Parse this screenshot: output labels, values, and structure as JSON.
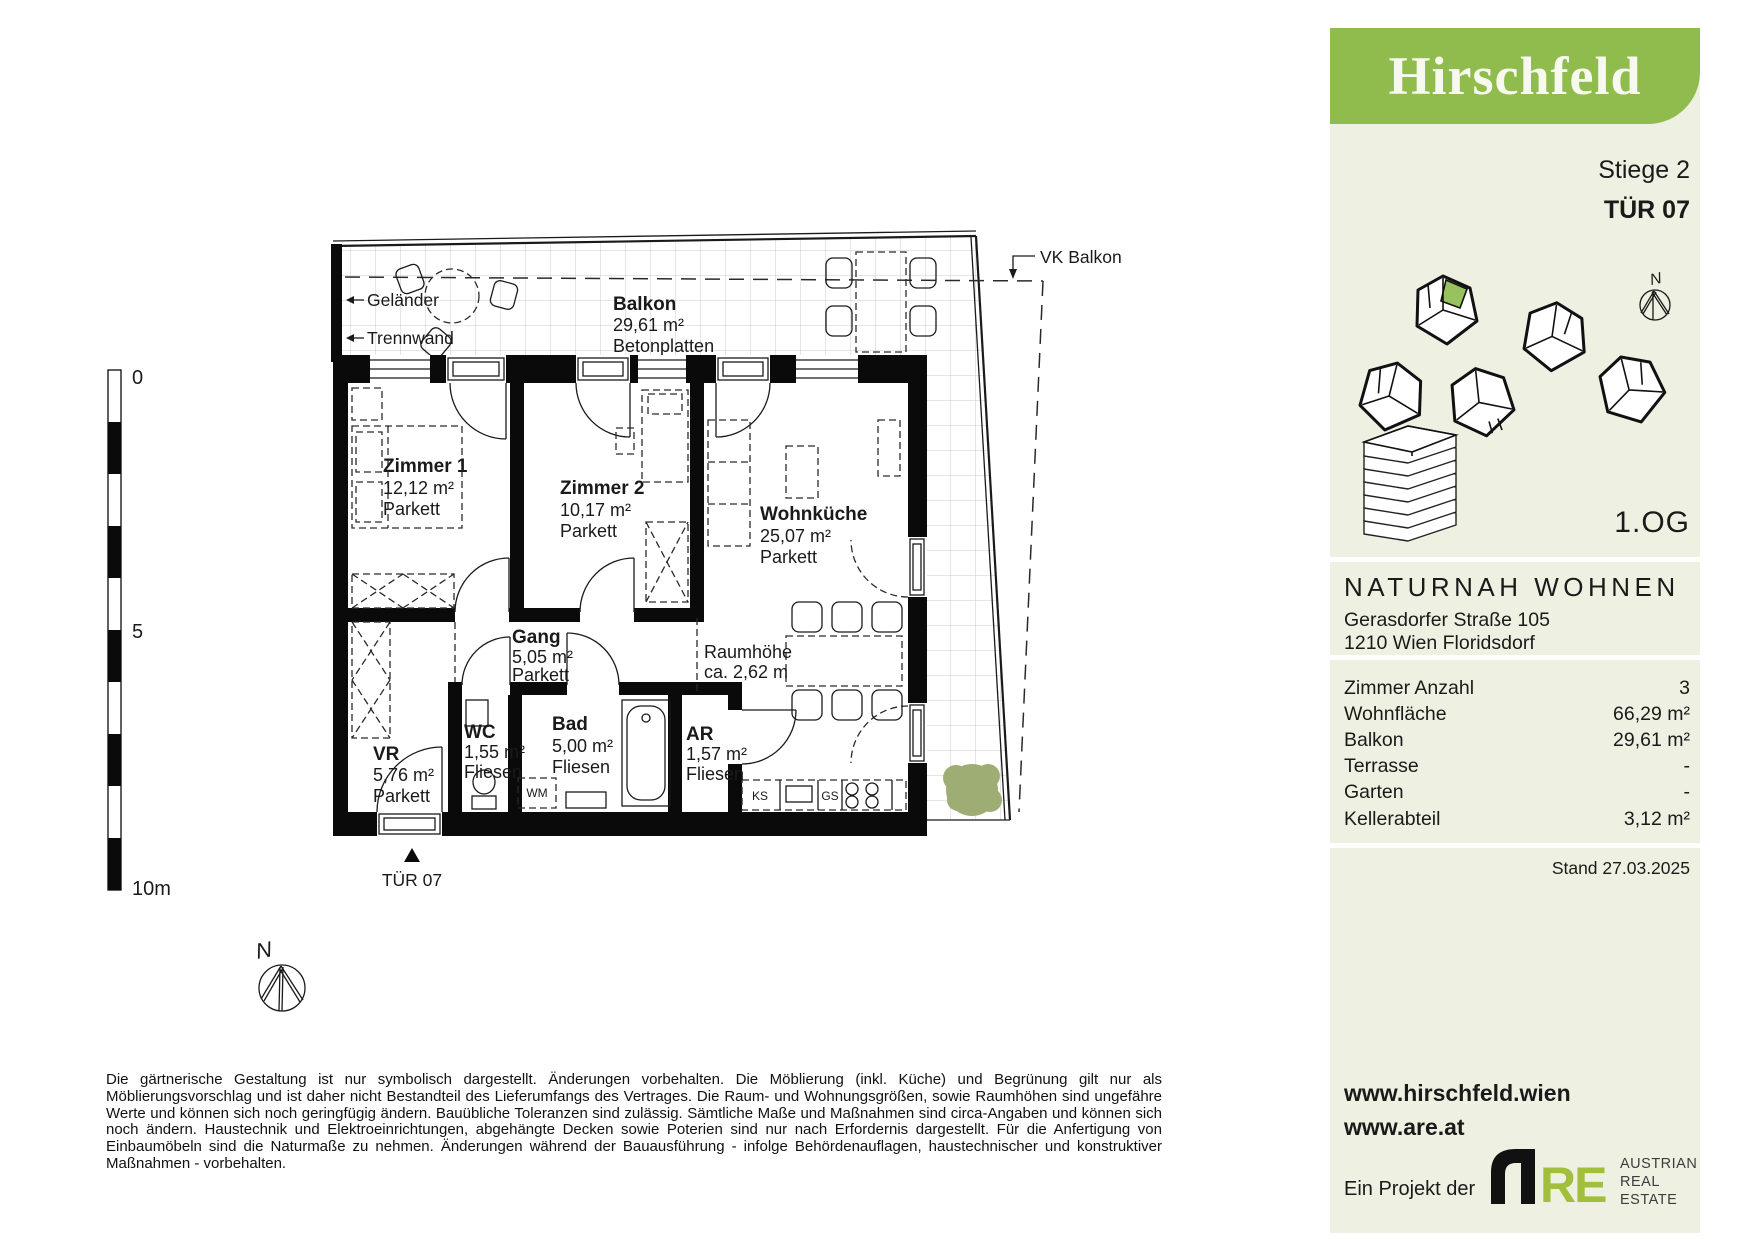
{
  "sidebar": {
    "logo_text": "Hirschfeld",
    "stiege": "Stiege 2",
    "tuer": "TÜR 07",
    "north_label": "N",
    "floor": "1.OG",
    "project": {
      "name": "NATURNAH WOHNEN",
      "address_line1": "Gerasdorfer Straße 105",
      "address_line2": "1210 Wien Floridsdorf"
    },
    "facts": {
      "rows": [
        {
          "label": "Zimmer Anzahl",
          "value": "3"
        },
        {
          "label": "Wohnfläche",
          "value": "66,29 m²"
        },
        {
          "label": "Balkon",
          "value": "29,61 m²"
        },
        {
          "label": "Terrasse",
          "value": "-"
        },
        {
          "label": "Garten",
          "value": "-"
        },
        {
          "label": "Kellerabteil",
          "value": "3,12 m²"
        }
      ]
    },
    "stand": "Stand 27.03.2025",
    "website1": "www.hirschfeld.wien",
    "website2": "www.are.at",
    "project_by": "Ein Projekt der",
    "are_logo": {
      "re": "RE",
      "line1": "AUSTRIAN",
      "line2": "REAL",
      "line3": "ESTATE"
    }
  },
  "plan": {
    "balcony": {
      "name": "Balkon",
      "area": "29,61 m²",
      "surface": "Betonplatten"
    },
    "rooms": [
      {
        "name": "Zimmer 1",
        "area": "12,12 m²",
        "floor": "Parkett"
      },
      {
        "name": "Zimmer 2",
        "area": "10,17 m²",
        "floor": "Parkett"
      },
      {
        "name": "Wohnküche",
        "area": "25,07 m²",
        "floor": "Parkett"
      },
      {
        "name": "Gang",
        "area": "5,05 m²",
        "floor": "Parkett"
      },
      {
        "name": "WC",
        "area": "1,55 m²",
        "floor": "Fliesen"
      },
      {
        "name": "Bad",
        "area": "5,00 m²",
        "floor": "Fliesen"
      },
      {
        "name": "AR",
        "area": "1,57 m²",
        "floor": "Fliesen"
      },
      {
        "name": "VR",
        "area": "5,76 m²",
        "floor": "Parkett"
      }
    ],
    "labels": {
      "gelaender": "Geländer",
      "trennwand": "Trennwand",
      "vk_balkon": "VK Balkon",
      "entry_door": "TÜR 07",
      "room_height_1": "Raumhöhe",
      "room_height_2": "ca. 2,62 m",
      "fridge": "KS",
      "dishwasher": "GS",
      "washing_machine": "WM",
      "north": "N"
    },
    "scale_bar": {
      "top": "0",
      "middle": "5",
      "bottom": "10m"
    }
  },
  "disclaimer": "Die gärtnerische Gestaltung ist nur symbolisch dargestellt. Änderungen vorbehalten. Die Möblierung (inkl. Küche) und Begrünung gilt nur als Möblierungsvorschlag und ist daher nicht Bestandteil des Lieferumfangs des Vertrages. Die Raum- und Wohnungsgrößen, sowie Raumhöhen sind ungefähre Werte und können sich noch geringfügig ändern. Bauübliche Toleranzen sind zulässig. Sämtliche Maße und Maßnahmen sind circa-Angaben und können sich noch ändern. Haustechnik und Elektroeinrichtungen, abgehängte Decken sowie Poterien sind nur nach Erfordernis dargestellt. Für die Anfertigung von Einbaumöbeln sind die Naturmaße zu nehmen. Änderungen während der Bauausführung - infolge Behördenauflagen, haustechnischer und konstruktiver Maßnahmen - vorbehalten.",
  "colors": {
    "brand_green": "#8fbc4c",
    "unit_green": "#98c25e",
    "iso_green": "#b9d186",
    "are_green": "#a2bf3b",
    "tree_green": "#9ead74",
    "sidebar_cream": "#eef1e2"
  }
}
